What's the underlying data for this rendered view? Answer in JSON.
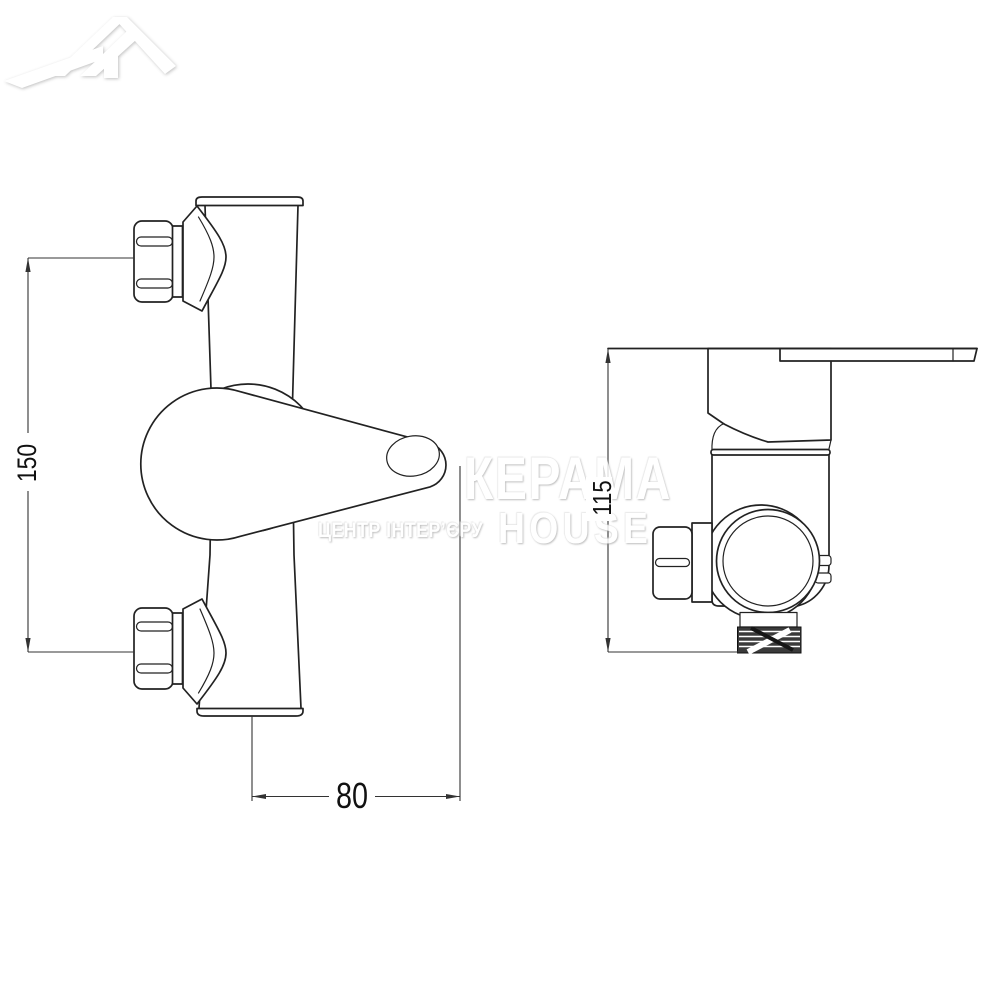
{
  "page": {
    "background": "#ffffff"
  },
  "diagram": {
    "type": "technical-drawing",
    "subject": "Wall-mounted shower mixer tap, front and side projection views",
    "line_color": "#222222",
    "views": [
      {
        "id": "front",
        "label": "front view"
      },
      {
        "id": "side",
        "label": "side view"
      }
    ],
    "dimensions": [
      {
        "id": "height",
        "value": "150",
        "orientation": "vertical",
        "view": "front"
      },
      {
        "id": "width",
        "value": "80",
        "orientation": "horizontal",
        "view": "front"
      },
      {
        "id": "depth",
        "value": "115",
        "orientation": "vertical",
        "view": "side"
      }
    ]
  },
  "watermark": {
    "brand": "КЕРАМА",
    "brand2": "HOUSE",
    "tagline": "ЦЕНТР ІНТЕР’ЄРУ",
    "logo": "house-roof-logo",
    "color": "#ffffff"
  }
}
